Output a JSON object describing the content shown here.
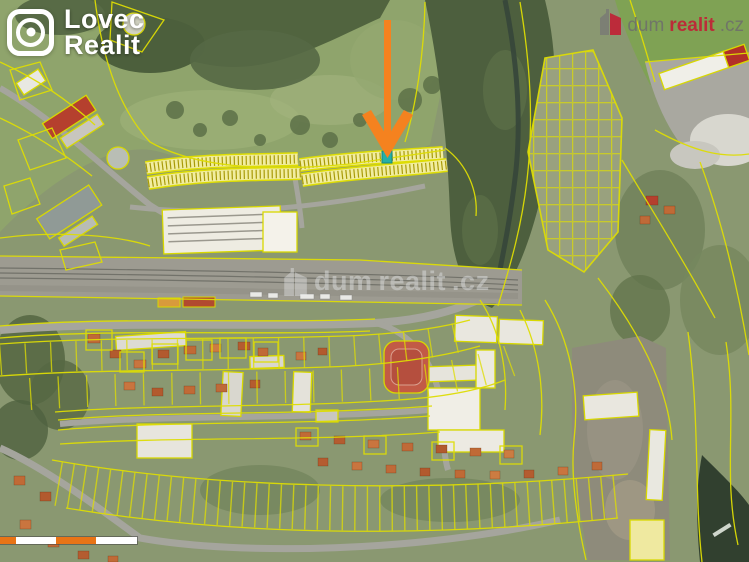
{
  "branding": {
    "lovec_realit": {
      "name": "Lovec Realit",
      "line1": "Lovec",
      "line2": "Realit",
      "icon": "target-scope-icon",
      "text_color": "#ffffff"
    },
    "dumrealit": {
      "name": "dumrealit.cz",
      "part_dum": "dum",
      "part_realit": "realit",
      "part_cz": ".cz",
      "red": "#c22035",
      "gray": "#6e6e6c",
      "icon": "house-icon"
    }
  },
  "watermark": {
    "part_dum": "dum",
    "part_realit": "realit",
    "part_cz": ".cz",
    "opacity": 0.4
  },
  "marker": {
    "shape": "down-arrow",
    "color": "#f5821f"
  },
  "highlighted_parcel": {
    "fill": "#25b0a7"
  },
  "map": {
    "type": "aerial-cadastral",
    "parcel_line_color": "#dedd04"
  },
  "scalebar": {
    "segment_colors": [
      "#e87416",
      "#ffffff",
      "#e87416",
      "#ffffff"
    ]
  }
}
